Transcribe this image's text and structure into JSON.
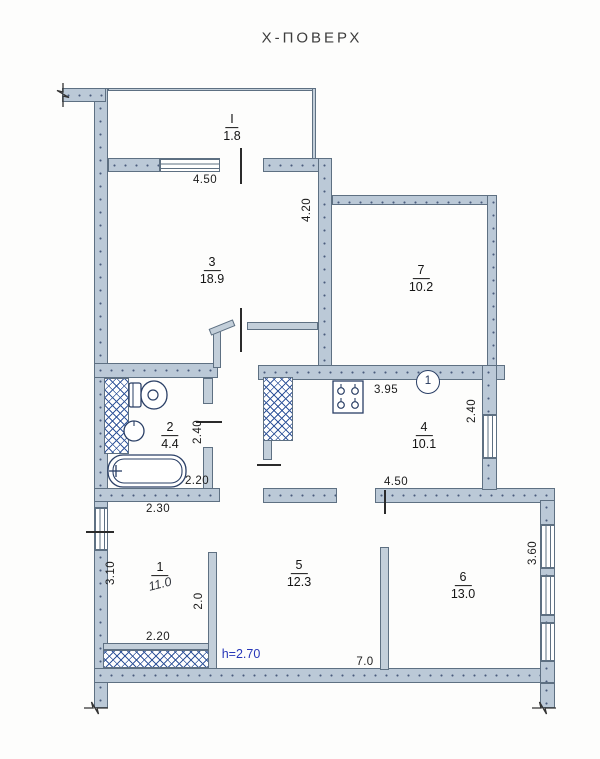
{
  "title": "Х-ПОВЕРХ",
  "plan": {
    "rooms": [
      {
        "number": "I",
        "area": "1.8"
      },
      {
        "number": "3",
        "area": "18.9"
      },
      {
        "number": "7",
        "area": "10.2"
      },
      {
        "number": "2",
        "area": "4.4"
      },
      {
        "number": "4",
        "area": "10.1"
      },
      {
        "number": "1",
        "area": "11.0"
      },
      {
        "number": "5",
        "area": "12.3"
      },
      {
        "number": "6",
        "area": "13.0"
      }
    ],
    "dimensions": {
      "room3_width": "4.50",
      "room3_height": "4.20",
      "kitchen_width": "3.95",
      "kitchen_height": "2.40",
      "kitchen_bottom_width": "4.50",
      "bath_height": "2.40",
      "bath_width": "2.20",
      "room1_top_width": "2.30",
      "room1_height": "3.10",
      "room1_right_height": "2.0",
      "room1_bottom_width": "2.20",
      "room5_width": "7.0",
      "room6_height": "3.60"
    },
    "ceiling_height_note": "h=2.70",
    "riser_mark": "1"
  },
  "colors": {
    "wall_fill": "#bbc9d7",
    "wall_line": "#5e7082",
    "hatch_line": "#35589c",
    "fixture_line": "#2a3f66",
    "note_blue": "#2736b8"
  }
}
